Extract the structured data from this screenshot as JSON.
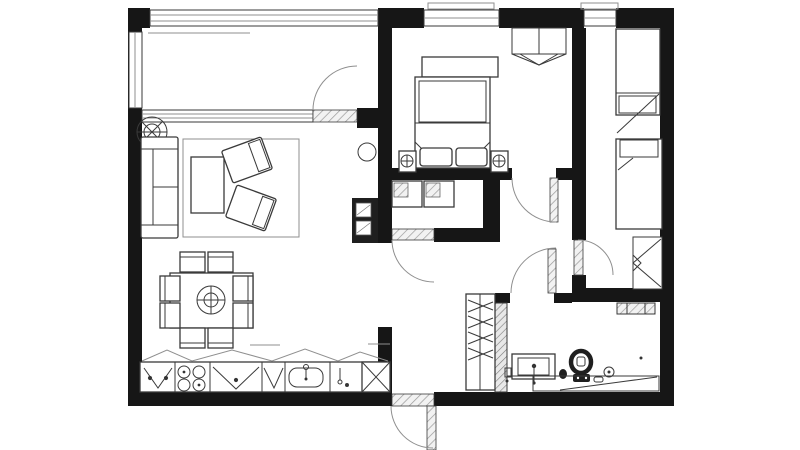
{
  "meta": {
    "title": "Apartment floor plan",
    "drawing_style": "monochrome CAD line drawing, top-down view, no text labels"
  },
  "colors": {
    "background": "#ffffff",
    "wall": "#161616",
    "line": "#3a3a3a",
    "line_light": "#8f8f8f",
    "hatch": "#9a9a9a",
    "fixture": "#1f1f1f"
  },
  "rooms": [
    "balcony-loggia-top-left",
    "living-dining-kitchen-left",
    "master-bedroom-top-center",
    "second-bedroom-right",
    "storage-laundry-closet-center",
    "hallway-center",
    "bathroom-bottom-right"
  ],
  "openings": {
    "windows": [
      "balcony-glazing-top",
      "balcony-side-window-left",
      "master-bedroom-window-top",
      "second-bedroom-window-top"
    ],
    "doors": [
      "balcony-door",
      "master-bedroom-door",
      "closet-door",
      "bathroom-door",
      "second-bedroom-door",
      "entrance-door-bottom"
    ]
  },
  "furniture": {
    "living_room": [
      "sofa",
      "rug",
      "coffee-table",
      "armchair x2",
      "plant-fan-symbol",
      "pendant-lamp",
      "dining-table",
      "dining-chair x8"
    ],
    "kitchen": [
      "counter-run",
      "cooktop-4-burners",
      "sink-with-faucet",
      "base-cabinet x4",
      "tall-unit-x-symbol",
      "upper-cabinet-zigzag-line"
    ],
    "master_bedroom": [
      "double-bed",
      "pillow x2",
      "nightstand-with-lamp x2",
      "bench-dresser",
      "corner-wardrobe-unit"
    ],
    "second_bedroom": [
      "single-bed x2",
      "wardrobe-with-arrow"
    ],
    "hallway": [
      "built-in-wardrobe-hangers"
    ],
    "closet": [
      "appliance-square x2"
    ],
    "bathroom": [
      "vanity-sink",
      "toilet",
      "floor-drain",
      "towel-radiator",
      "bathtub-counter-strip",
      "utility-shaft-black"
    ]
  }
}
